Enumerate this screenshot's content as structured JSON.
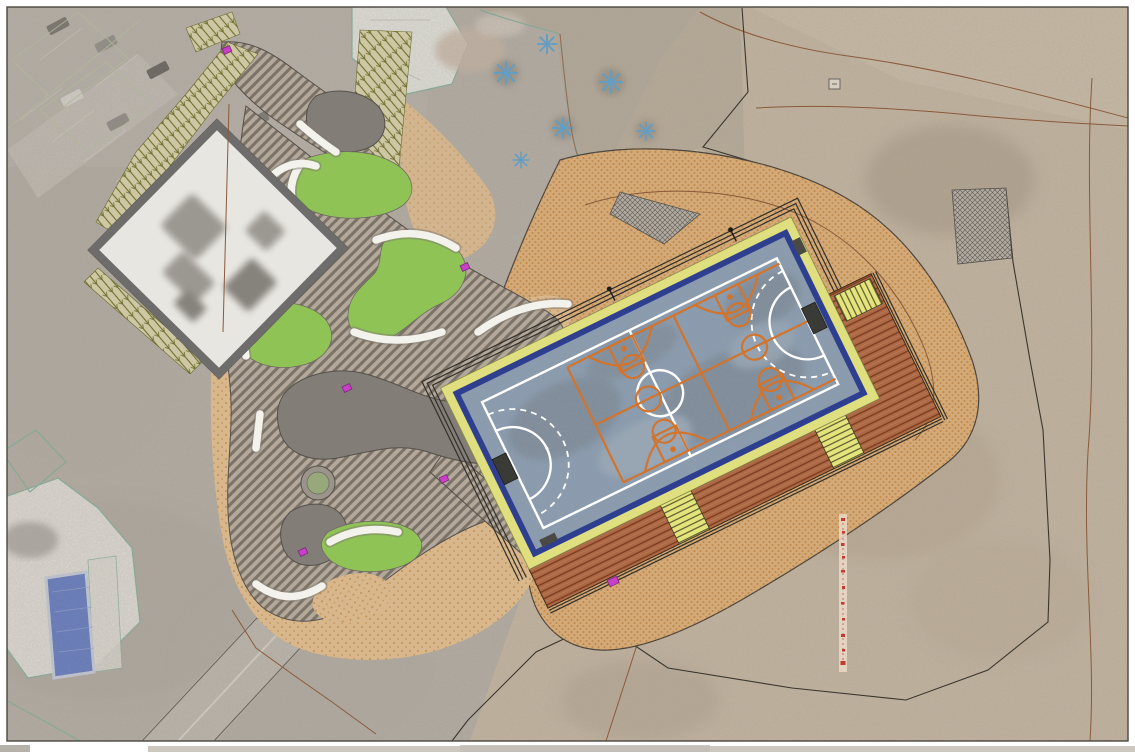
{
  "document": {
    "type": "architectural-site-plan",
    "description": "Aerial photo with overlaid landscape design: multi-sport court (futsal + cross basketball) on gravel mound, timber deck, garden plaza with lawns and benches, school building, existing buildings and parking",
    "visible_text_labels": []
  },
  "palette": {
    "page-bg": "#ffffff",
    "frame": "#4a463f",
    "aerial-gray": "#b4ada4",
    "desert-tan": "#c6b6a0",
    "road-gray": "#bdb7ae",
    "sand": "#d8b78c",
    "sand-dots": "#b97f3c",
    "mound-sand": "#d2a977",
    "mound-dots": "#b5722e",
    "paving-light": "#b3a89a",
    "paving-dark": "#7b7368",
    "plaza-gray": "#827d77",
    "plaza-outline": "#55504a",
    "lawn-green": "#8fc356",
    "veg-base": "#cdc7a4",
    "veg-olive": "#6f7030",
    "building-roof": "#e8e6e1",
    "building-wall": "#6e6d6b",
    "court-yellow": "#dfdf7f",
    "court-navy": "#2f3f90",
    "court-blue": "#7e9dc1",
    "line-white": "#ffffff",
    "line-orange": "#d2742c",
    "deck-brown": "#ad6845",
    "deck-line": "#7c3e20",
    "step-yellow": "#e4e47d",
    "step-line": "#4f4a28",
    "magenta": "#c93fc9",
    "teal-cad": "#7fae9a",
    "green-cad": "#b5c49b",
    "contour-brown": "#8a5a3a",
    "boundary-black": "#3a362e",
    "red-marks": "#c23b2e",
    "pool-blue": "#5873c4",
    "palm-blue": "#4f9fd6",
    "white-bench": "#f4f2ec"
  },
  "annotations": {
    "magenta_utility_markers": 6,
    "red_survey_tick_marks": 11,
    "palm_trees": 6,
    "lawn_patches": 4,
    "deck_step_flights": 3
  },
  "features": [
    "multi-sport-court",
    "futsal-markings",
    "basketball-cross-courts",
    "timber-deck",
    "gravel-mound",
    "school-building",
    "garden-plaza",
    "hatched-paths",
    "lawns-with-benches",
    "tree-planter",
    "existing-parking",
    "existing-building-with-pool",
    "palm-garden",
    "site-boundary",
    "contour-lines",
    "survey-line"
  ]
}
